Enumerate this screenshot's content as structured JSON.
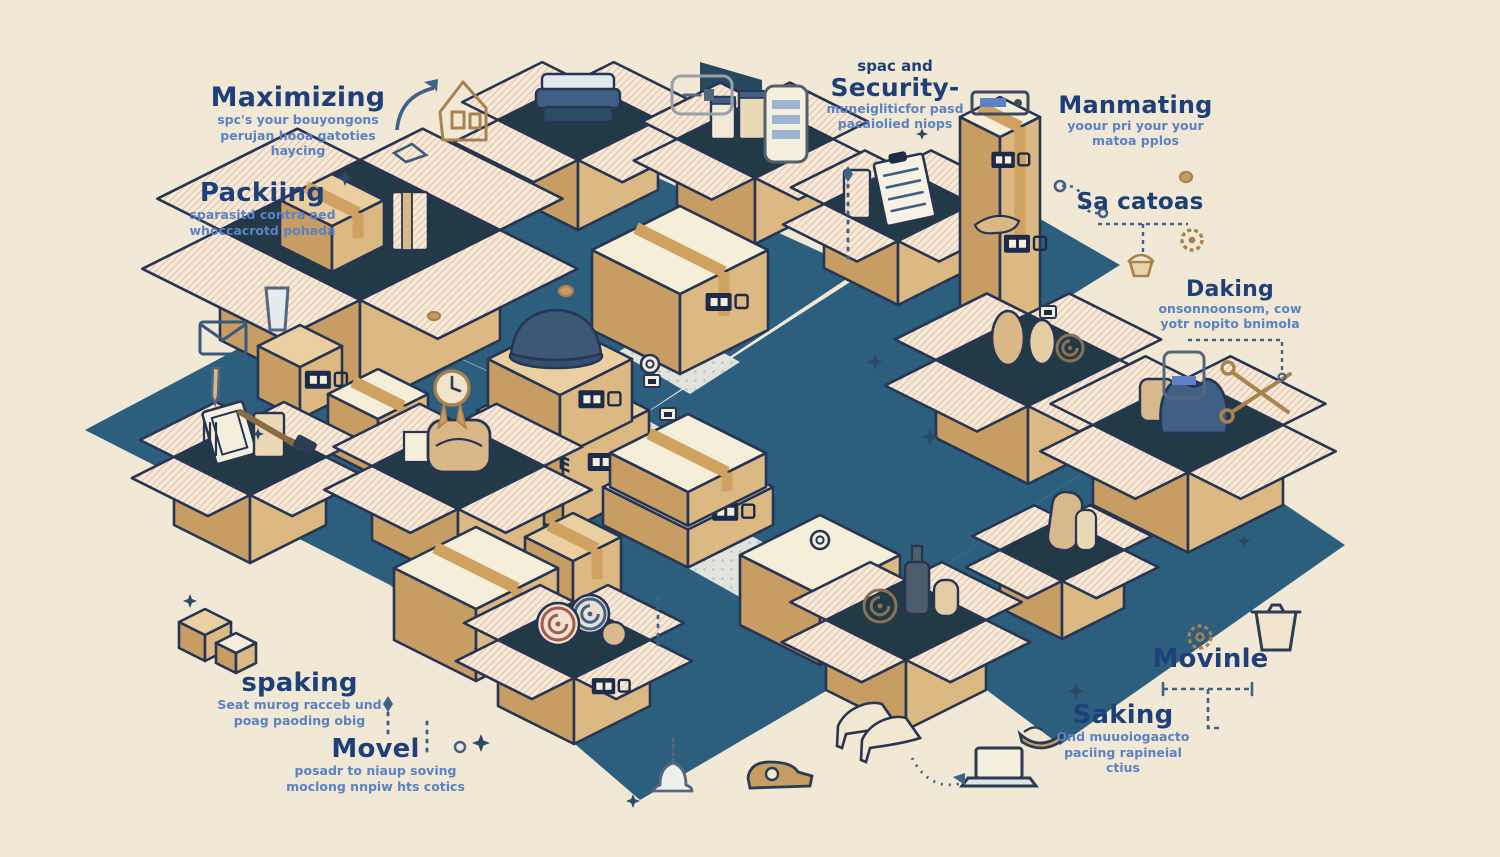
{
  "page": {
    "kind": "isometric illustration / moving-and-packing infographic",
    "background": "#f1e9d6"
  },
  "palette": {
    "background": "#f1e9d6",
    "floor": "#2c5f7e",
    "floor_path": "#e2e3dd",
    "floor_path_dot": "#bdc1b8",
    "box_light": "#eccfa0",
    "box_mid": "#dcb983",
    "box_dark": "#c79d63",
    "box_cream": "#f5eed8",
    "box_interior": "#223a46",
    "flap_hatch_bg": "#f7ead8",
    "flap_hatch_line": "#e5c0a8",
    "tape": "#cfa262",
    "outline": "#263652",
    "stamp": "#1c2b4a",
    "heading_blue": "#1d3f7a",
    "subtext_blue": "#5b82c4",
    "accent_line": "#3f6287",
    "icon_tan": "#a9824f",
    "icon_grey": "#55677e",
    "item_navy": "#3f5f85",
    "item_slate": "#4e5d6b",
    "rug_red": "#a85a4e",
    "rug_teal": "#3f6287"
  },
  "labels": {
    "maximizing": {
      "heading": "Maximizing",
      "lines": [
        "spc's your bouyongons",
        "perujan hooa gatoties",
        "haycing"
      ]
    },
    "packing": {
      "heading": "Packiing",
      "lines": [
        "sparasitd contra aed",
        "whoccacrotd pohada"
      ]
    },
    "security": {
      "pre": "spac and",
      "heading": "Security-",
      "lines": [
        "muneigliticfor pasd",
        "pacaiolied niops"
      ]
    },
    "manmating": {
      "heading": "Manmating",
      "lines": [
        "yoour pri your your",
        "matoa pplos"
      ]
    },
    "sacatoas": {
      "heading": "Sa catoas"
    },
    "daking": {
      "heading": "Daking",
      "lines": [
        "onsonnoonsom, cow",
        "yotr nopito bnimola"
      ]
    },
    "spaking": {
      "heading": "spaking",
      "lines": [
        "Seat murog racceb und",
        "poag paoding obig"
      ]
    },
    "movel": {
      "heading": "Movel",
      "lines": [
        "posadr to niaup soving",
        "moclong nnpiw hts cotics"
      ]
    },
    "movinle": {
      "heading": "Movinle"
    },
    "saking": {
      "heading": "Saking",
      "lines": [
        "Ond muuoiogaacto",
        "paciing rapineial",
        "ctius"
      ]
    }
  },
  "box_stamps": {
    "pipe": "PIPE"
  },
  "icons": [
    "house-icon",
    "price-tag-icon",
    "smartphone-icon",
    "radio-icon",
    "envelope-icon",
    "glass-icon",
    "pen-icon",
    "hammer-icon",
    "clock-badge-icon",
    "gear-icon",
    "cupcake-icon",
    "scissors-icon",
    "smartphone2-icon",
    "trash-bin-icon",
    "gear2-icon",
    "antenna-icon",
    "laptop-icon",
    "bowl-icon",
    "bell-icon",
    "tape-dispenser-icon",
    "paper-diamond-icon",
    "coin-icon",
    "tape-roll-icon",
    "sparkle-icon",
    "curved-arrow-icon",
    "dashed-arrow-icon"
  ]
}
